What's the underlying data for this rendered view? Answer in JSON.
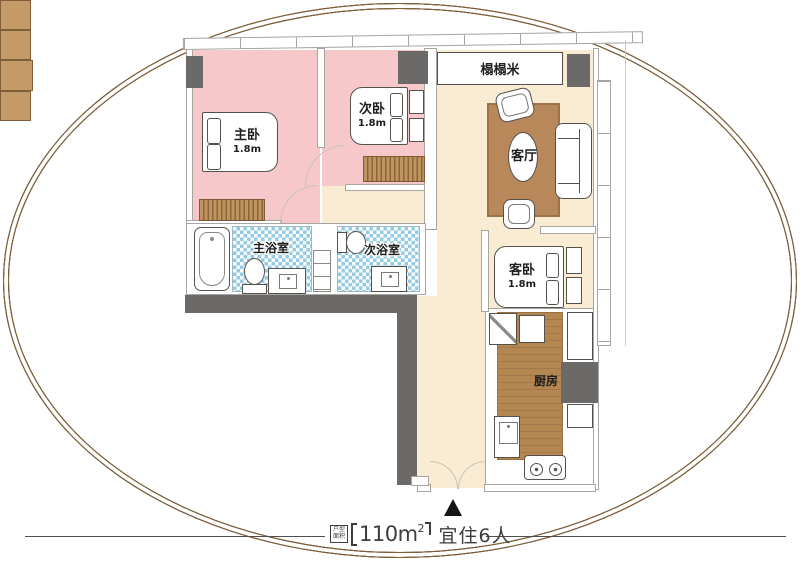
{
  "floorplan": {
    "rooms": {
      "master_bedroom": {
        "name": "主卧",
        "size": "1.8m"
      },
      "second_bedroom": {
        "name": "次卧",
        "size": "1.8m"
      },
      "guest_bedroom": {
        "name": "客卧",
        "size": "1.8m"
      },
      "living_room": {
        "name": "客厅"
      },
      "tatami": {
        "name": "榻榻米"
      },
      "master_bathroom": {
        "name": "主浴室"
      },
      "second_bathroom": {
        "name": "次浴室"
      },
      "kitchen": {
        "name": "厨房"
      }
    },
    "colors": {
      "bedroom_pink": "#f7c8ca",
      "living_beige": "#faecd2",
      "bath_tile_blue": "#93cbe3",
      "wood_brown": "#b3874f",
      "rug_brown": "#b9885a",
      "structure_dark_gray": "#6c6a68",
      "wall_line_gray": "#a8a5a0"
    }
  },
  "footer": {
    "area_box_label": "户型面积",
    "area_value": "110m",
    "area_superscript": "2",
    "occupancy_label": "宜住6人"
  }
}
